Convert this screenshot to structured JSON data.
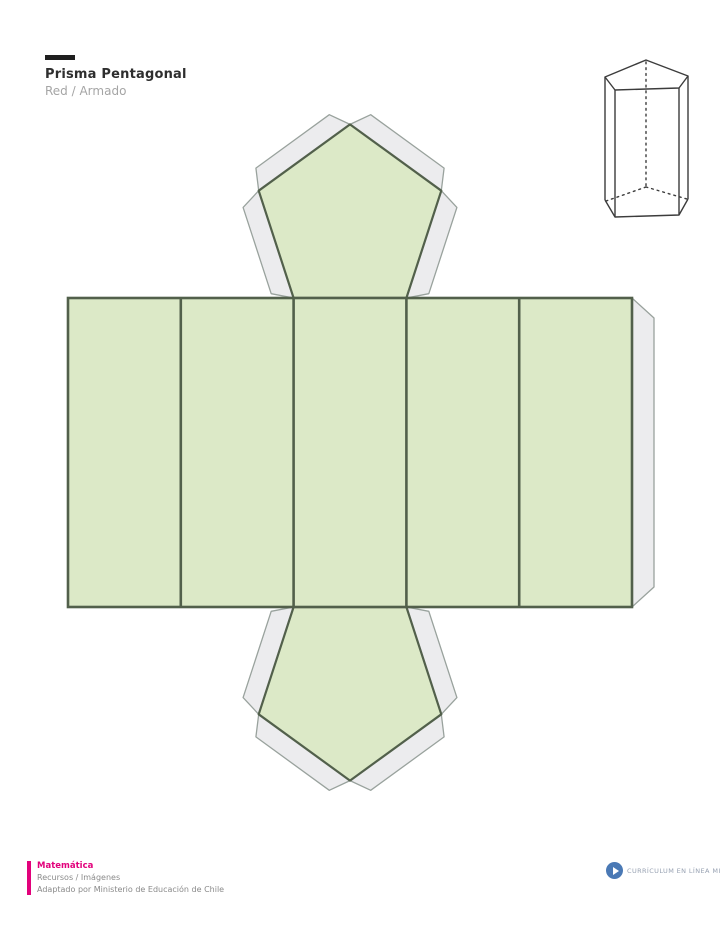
{
  "page": {
    "background_color": "#ffffff"
  },
  "header": {
    "accent_bar_color": "#1f1f1f",
    "title": "Prisma Pentagonal",
    "subtitle": "Red / Armado",
    "title_color": "#2e2e2e",
    "subtitle_color": "#a5a5a5"
  },
  "figure3d": {
    "kind": "pentagonal-prism-line-drawing",
    "stroke_color": "#3c3c3c"
  },
  "net": {
    "shape": "pentagonal-prism-net",
    "rect_faces": 5,
    "pentagon_faces": 2,
    "colors": {
      "face_fill": "#dce9c7",
      "face_stroke": "#52604b",
      "tab_fill": "#ececee",
      "tab_stroke": "#99a29d"
    },
    "geometry": {
      "strip_x": 68,
      "strip_y": 298,
      "face_width": 112.8,
      "strip_height": 309,
      "tab_depth": 20,
      "tab_chamfer": 11,
      "side_tab_width": 22,
      "side_tab_chamfer": 20,
      "face_stroke_width": 2.6,
      "pentagon_stroke_width": 2.2,
      "tab_stroke_width": 1.3
    }
  },
  "footer": {
    "accent_color": "#e2017b",
    "subject": "Matemática",
    "resource": "Recursos / Imágenes",
    "attribution": "Adaptado por Ministerio de Educación de Chile",
    "logo_color": "#4a79b5",
    "logo_text": "Currículum en línea Mineduc"
  }
}
